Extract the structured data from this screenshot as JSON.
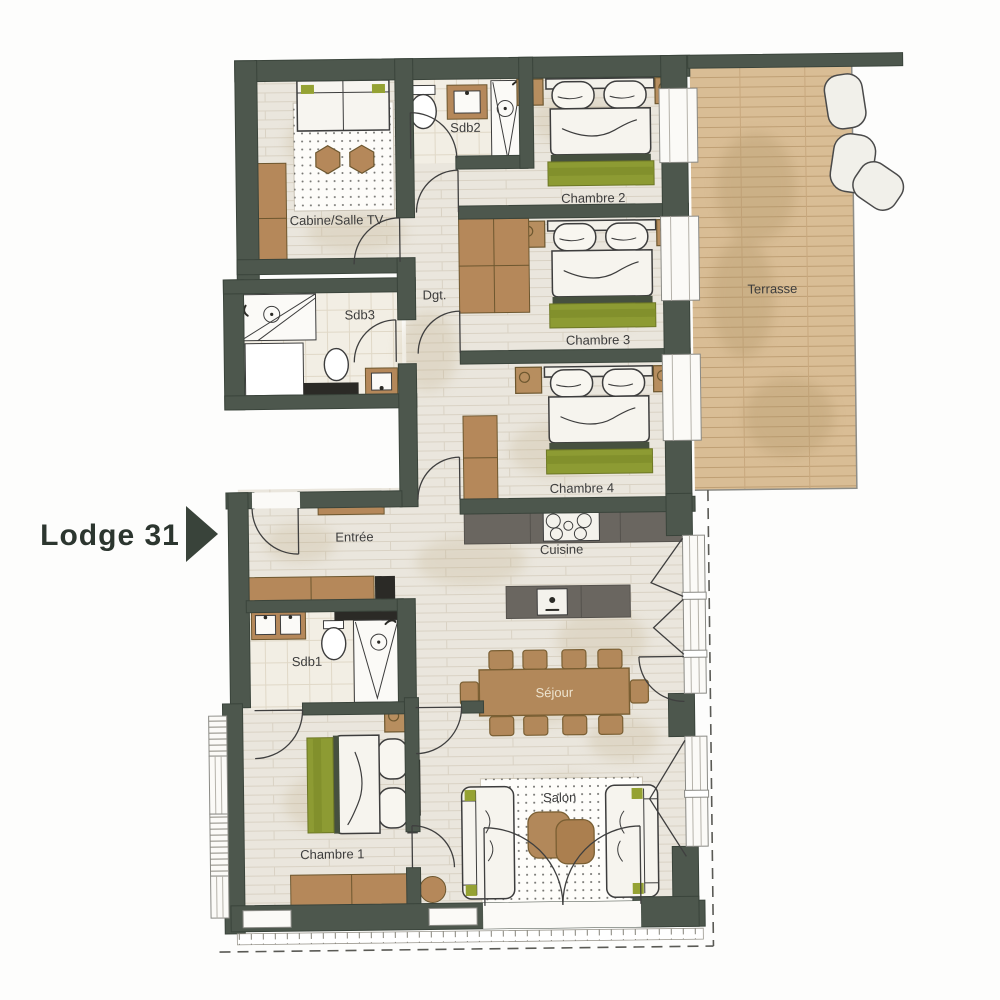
{
  "header": {
    "title": "Lodge 31"
  },
  "rooms": {
    "cabine": "Cabine/Salle TV",
    "sdb2": "Sdb2",
    "chambre2": "Chambre 2",
    "dgt": "Dgt.",
    "sdb3": "Sdb3",
    "chambre3": "Chambre 3",
    "terrasse": "Terrasse",
    "chambre4": "Chambre 4",
    "entree": "Entrée",
    "cuisine": "Cuisine",
    "sdb1": "Sdb1",
    "sejour": "Séjour",
    "salon": "Salon",
    "chambre1": "Chambre 1"
  },
  "colors": {
    "wall": "#4d574d",
    "wall_edge": "#3a443b",
    "floor": "#eae6dd",
    "tile": "#f2eee4",
    "deck": "#d9bd95",
    "wood_furniture": "#b58b5c",
    "wood_outline": "#6d572f",
    "bed_green": "#8d9b33",
    "counter_dark": "#6a6660",
    "charcoal": "#2b2a26",
    "label_text": "#3c3c3c",
    "arrow": "#39433a"
  }
}
